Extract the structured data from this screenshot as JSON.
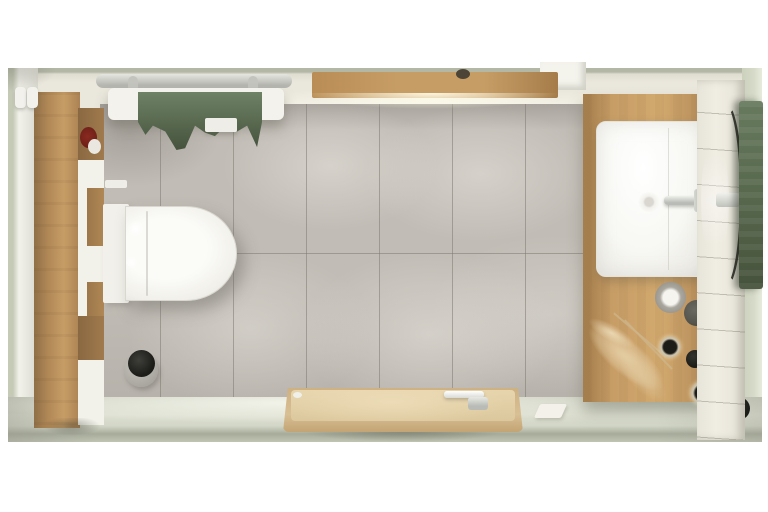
{
  "scene": {
    "description": "Top-down 3D render of a modern bathroom with oak furniture, gray large-format tiles, sage green textiles and white sanitaryware",
    "labels": {
      "room": "Bathroom top view",
      "top_wall": "Top wall",
      "left_wall": "Left wall",
      "right_wall": "Sage green right wall",
      "tile_wall": "Gray large-format tiles",
      "floor": "Light floor strip",
      "towel_radiator": "White towel radiator",
      "hanging_towel": "Green towel on radiator",
      "wall_shelf": "Oak wall shelf with spotlight",
      "wall_recess": "Wall recess",
      "storage_cabinet": "Tall oak storage cabinet",
      "shampoo_bottles": "White bottles on cabinet",
      "red_towel_roll": "Rolled red towel in cabinet niche",
      "toilet": "Wall-hung toilet",
      "toilet_tank": "Concealed cistern panel",
      "toilet_brush": "Black toilet brush set",
      "bathtub": "Beige bathtub with wooden deck",
      "tub_faucet": "Chrome tub faucet",
      "soap_bar": "Soap on floor",
      "vanity_counter": "Oak vanity countertop",
      "washbasin": "Square countertop washbasin",
      "basin_faucet": "Chrome basin mixer",
      "basin_drain": "Basin drain",
      "soap_dispenser": "Soap dispenser",
      "cup": "Dark tumbler",
      "candle_jar": "Candle jar with black lid",
      "black_jar": "Black round jar",
      "pampas_grass": "Dried pampas grass",
      "slat_wall": "White slatted wall panel",
      "round_mirror": "Round wall mirror",
      "bath_towel": "Sage bath towel on rail"
    },
    "colors": {
      "page_bg": "#ffffff",
      "cream": "#eae7dc",
      "top_edge": "#b3b7a6",
      "tile": "#c1bcb5",
      "tile_dark": "#a9a49d",
      "grout": "#7f7a73",
      "floor": "#dcdfd0",
      "baseboard": "#a7ab9a",
      "wall_white": "#f2f1ea",
      "outer_green": "#c5cab7",
      "sage_wall": "#cbd1bd",
      "wood": "#c79d66",
      "wood_dark": "#b08756",
      "wood_deep": "#8a6841",
      "red_accent": "#6e2018",
      "porcelain": "#f3f2ed",
      "chrome": "#b9bcb6",
      "chrome_dark": "#9fa29c",
      "towel_green": "#57684f",
      "towel_green_light": "#6e8266",
      "towel_green_dark": "#45523d",
      "tub_beige": "#d8bf94",
      "tub_beige_light": "#e7d5ae",
      "tub_rim": "#c3a474",
      "slat": "#f0ede3",
      "rtowel": "#57684d",
      "rtowel_light": "#677a5e",
      "rtowel_dark": "#46523c",
      "black": "#1c1c19",
      "pampas": "#cdb489",
      "glass": "#cfc7b0",
      "cup_gray": "#55544d",
      "dispenser_gray": "#aaa79f"
    }
  }
}
